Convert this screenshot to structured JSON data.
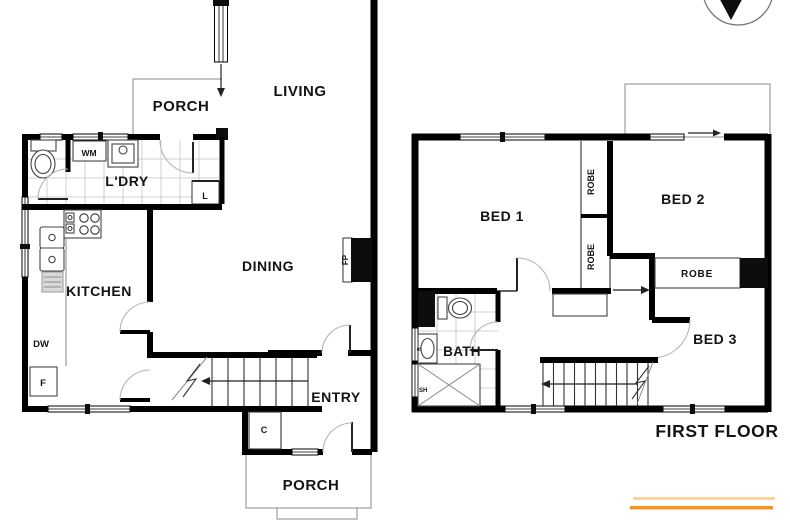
{
  "ground_floor": {
    "rooms": {
      "porch_top": "PORCH",
      "living": "LIVING",
      "laundry": "L'DRY",
      "kitchen": "KITCHEN",
      "dining": "DINING",
      "entry": "ENTRY",
      "porch_bottom": "PORCH"
    },
    "labels": {
      "washing_machine": "WM",
      "linen": "L",
      "dishwasher": "DW",
      "fridge": "F",
      "fireplace": "FP",
      "cupboard": "C"
    }
  },
  "first_floor": {
    "title": "FIRST FLOOR",
    "rooms": {
      "bed1": "BED 1",
      "bed2": "BED 2",
      "bed3": "BED 3",
      "bath": "BATH"
    },
    "labels": {
      "robe_bed1": "ROBE",
      "robe_bed2": "ROBE",
      "robe_bed3": "ROBE",
      "shower": "SH",
      "basin": "B"
    }
  },
  "colors": {
    "walls": "#000000",
    "background": "#FFFFFF",
    "accent_orange": "#F7941E",
    "accent_orange_light": "#FAD5A0"
  }
}
